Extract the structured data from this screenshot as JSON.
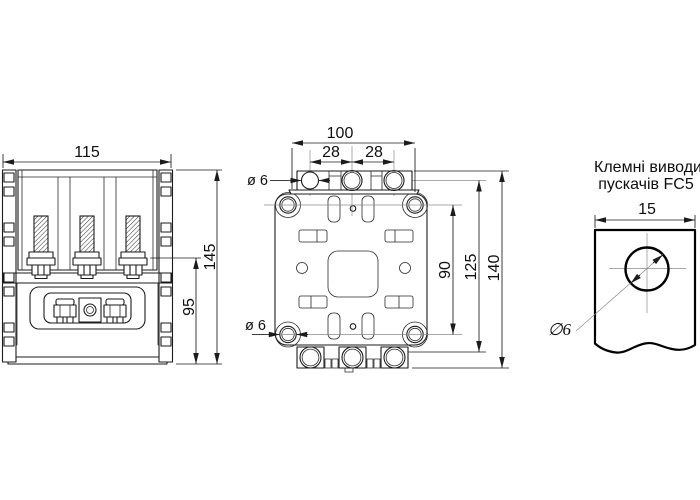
{
  "colors": {
    "background": "#ffffff",
    "line": "#1b1b1b"
  },
  "front_view": {
    "dim_width": "115",
    "dim_height_total": "145",
    "dim_height_base": "95"
  },
  "mounting_view": {
    "dim_overall_width": "100",
    "dim_pitch_left": "28",
    "dim_pitch_right": "28",
    "dim_hole_top": "ø 6",
    "dim_hole_bottom": "ø 6",
    "dim_hole_span": "90",
    "dim_body_height": "125",
    "dim_total_height": "140"
  },
  "terminal_view": {
    "caption_line1": "Клемні виводи",
    "caption_line2": "пускачів FC5",
    "dim_width": "15",
    "dim_hole_dia": "∅6"
  }
}
